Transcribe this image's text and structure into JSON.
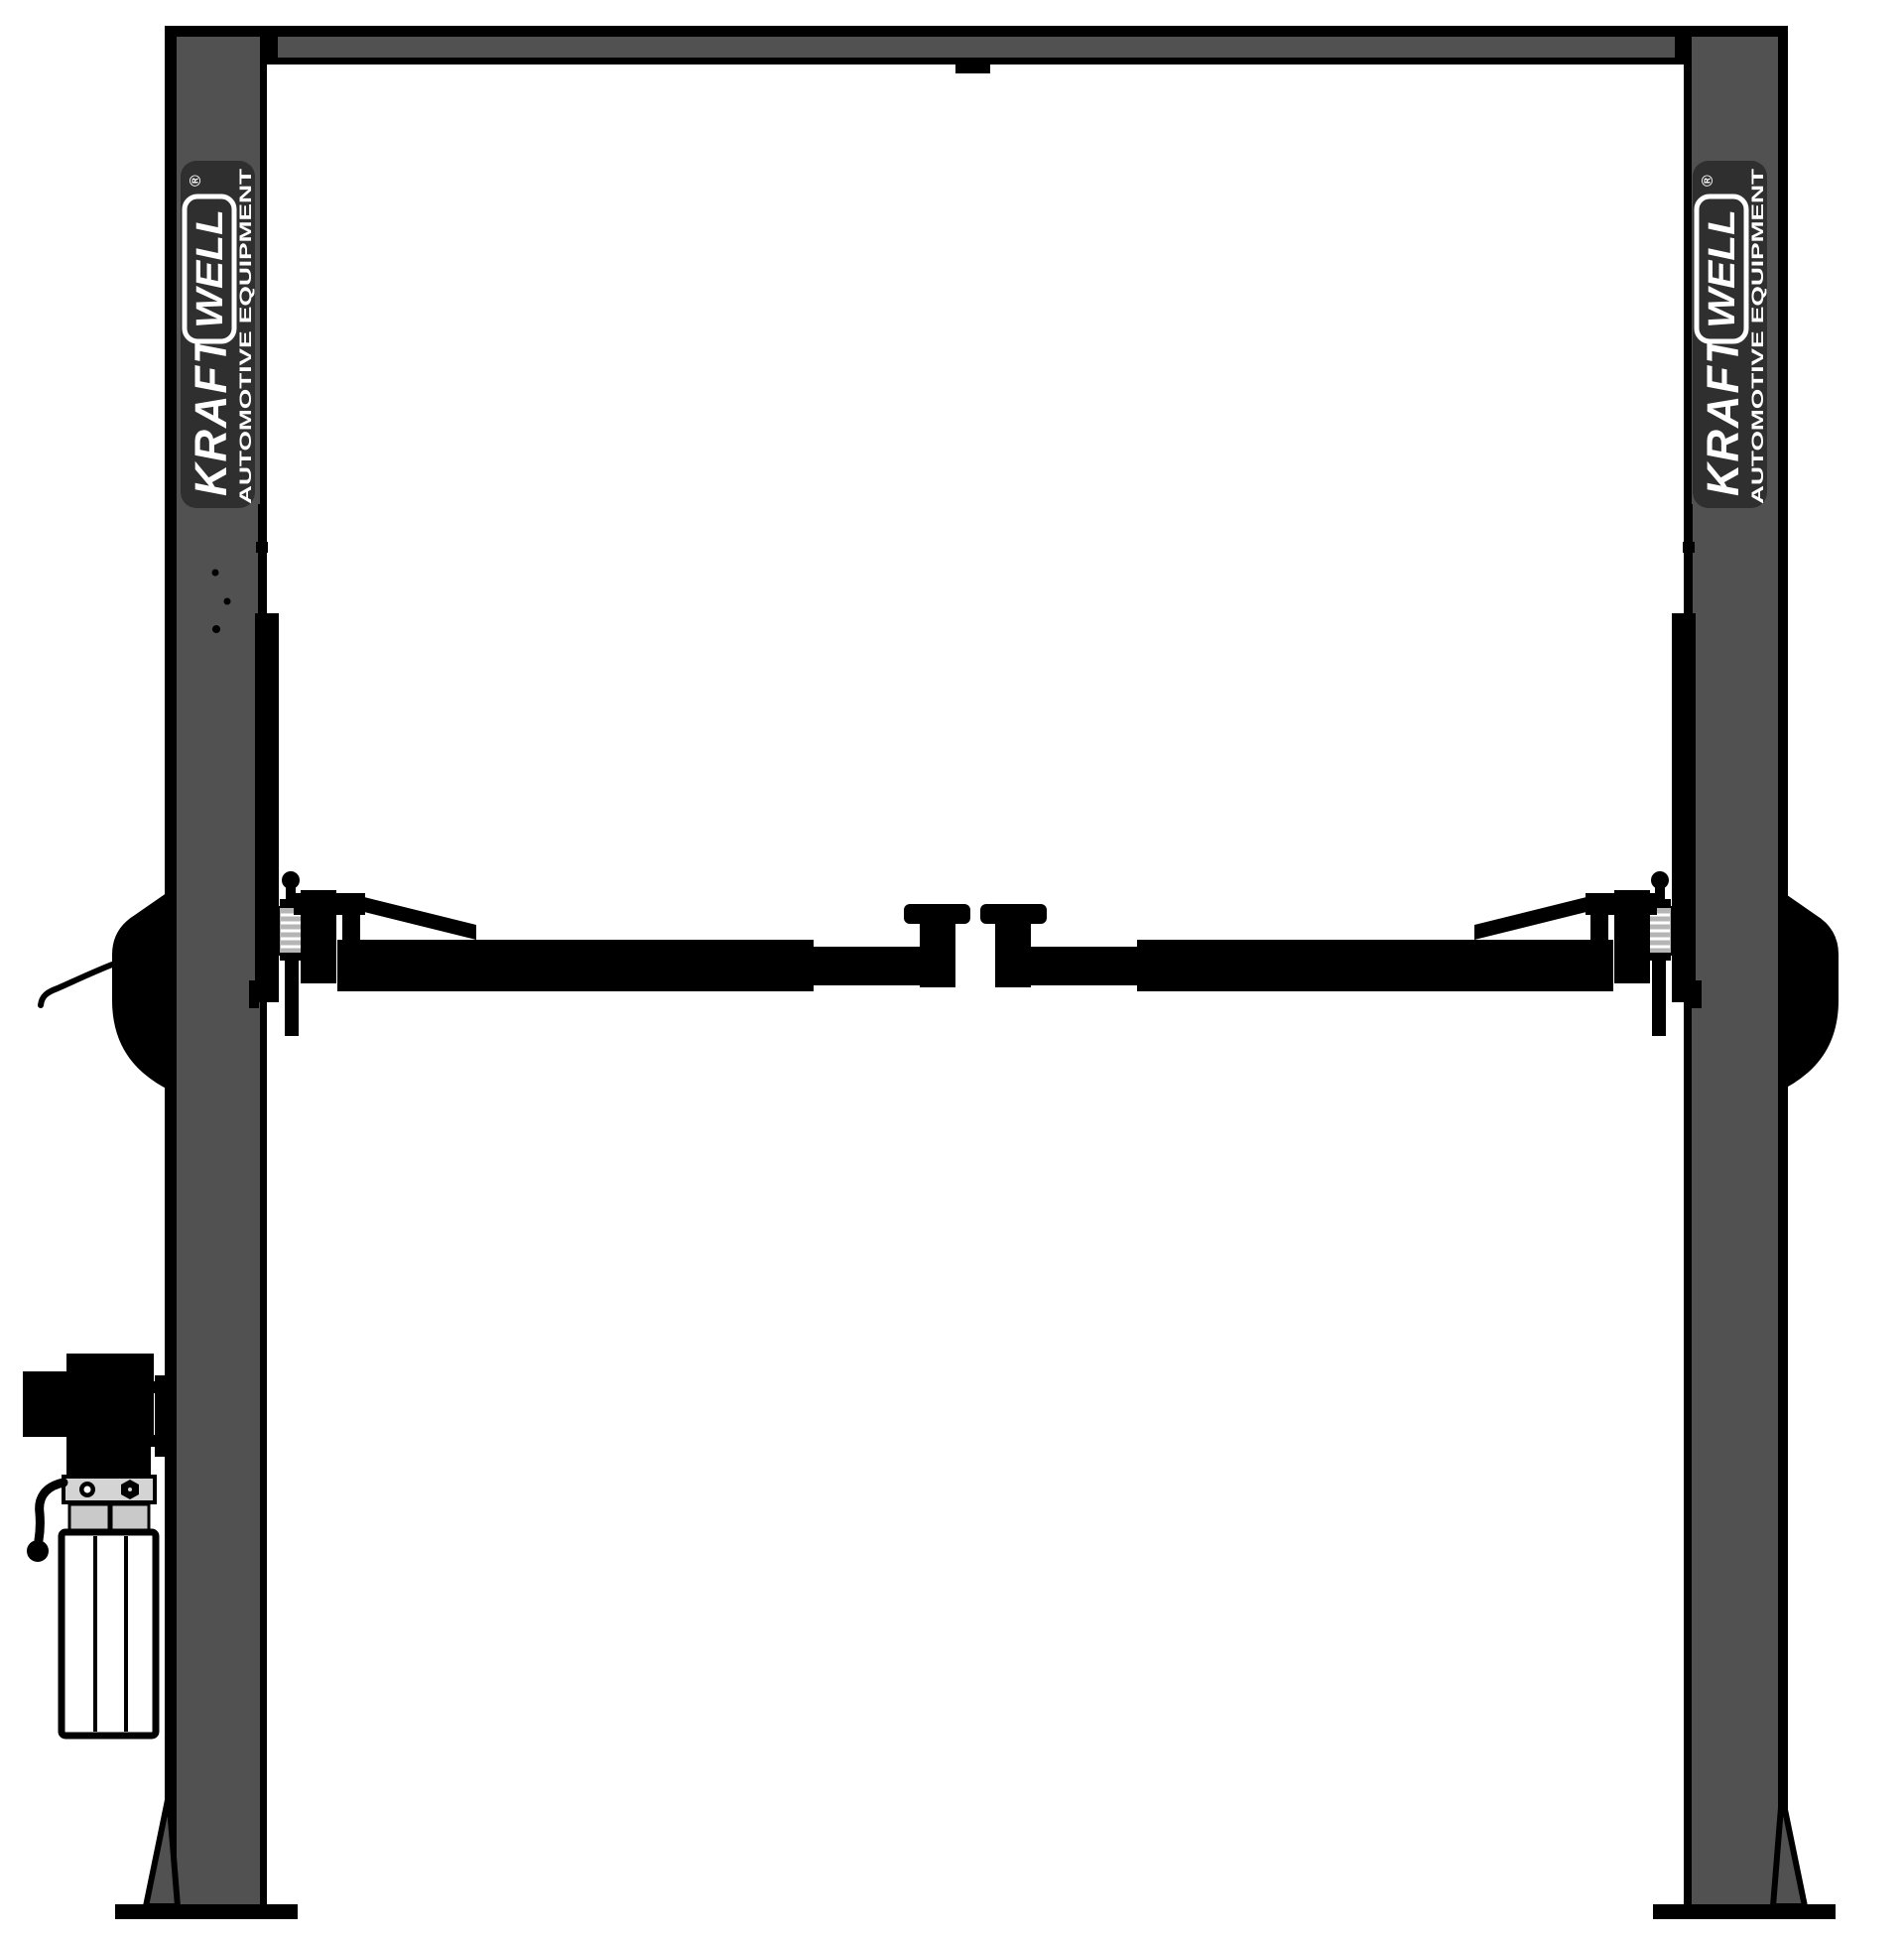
{
  "brand": {
    "name": "KRAFT",
    "sub": "WELL",
    "registered": "®",
    "tagline": "AUTOMOTIVE EQUIPMENT"
  },
  "colors": {
    "background": "#ffffff",
    "steel_gray": "#515151",
    "outline_black": "#000000",
    "badge_background": "#2f2f2f",
    "logo_text_white": "#ffffff",
    "spring_gray": "#b5b5b5",
    "manifold_gray": "#d4d4d4",
    "valve_block_gray": "#c9c9c9",
    "tank_white": "#ffffff"
  }
}
